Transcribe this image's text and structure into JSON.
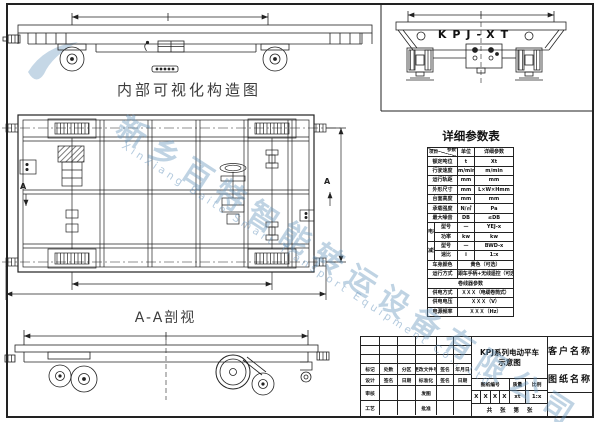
{
  "labels": {
    "internal_view": "内部可视化构造图",
    "section_view": "A-A剖视",
    "model": "KPJ-XT",
    "section_marker_left": "A",
    "section_marker_right": "A"
  },
  "watermark": {
    "company_cn": "新乡百特智能转运设备有限公司",
    "company_en": "Xinxiang Baite Smart Transport Equipment Co., Ltd"
  },
  "param_table": {
    "title": "详细参数表",
    "header": {
      "corner_top": "参数",
      "corner_bottom": "项目",
      "unit": "单位",
      "value": "详细参数"
    },
    "rows": [
      {
        "label": "额定吨位",
        "unit": "t",
        "value": "Xt"
      },
      {
        "label": "行驶速度",
        "unit": "m/min",
        "value": "m/min"
      },
      {
        "label": "运行轨距",
        "unit": "mm",
        "value": "mm"
      },
      {
        "label": "外形尺寸",
        "unit": "mm",
        "value": "L×W×Hmm"
      },
      {
        "label": "台面高度",
        "unit": "mm",
        "value": "mm"
      },
      {
        "label": "承载强度",
        "unit": "N/㎡",
        "value": "Pa"
      },
      {
        "label": "最大噪音",
        "unit": "DB",
        "value": "≤DB"
      },
      {
        "group": "电机",
        "label": "型号",
        "unit": "—",
        "value": "YEJ-x"
      },
      {
        "label": "功率",
        "unit": "kw",
        "value": "kw"
      },
      {
        "group": "减速机",
        "label": "型号",
        "unit": "—",
        "value": "BWD-x"
      },
      {
        "label": "速比",
        "unit": "i",
        "value": "1:x"
      },
      {
        "label": "车身颜色",
        "value": "黄色（可选）"
      },
      {
        "label": "运行方式",
        "value": "跟车手柄+无线遥控（可选）"
      },
      {
        "section": "卷线器参数"
      },
      {
        "label": "供电方式",
        "value": "ＸＸＸ（电缆卷筒式）"
      },
      {
        "label": "供电电压",
        "value": "ＸＸＸ（V）"
      },
      {
        "label": "电源频率",
        "value": "ＸＸＸ（Hz）"
      }
    ]
  },
  "title_block": {
    "rev_row": [
      "标记",
      "处数",
      "分区",
      "更改文件号",
      "签名",
      "年月日"
    ],
    "sign_row": [
      "设计",
      "签名",
      "日期",
      "标准化",
      "签名",
      "日期"
    ],
    "check_label": "审核",
    "issue_label": "发图",
    "process_label": "工艺",
    "approve_label": "批准",
    "title_line1": "KPJ系列电动平车",
    "title_line2": "示意图",
    "no_label": "图纸编号",
    "weight_label": "质量",
    "scale_label": "比例",
    "no_value": [
      "X",
      "X",
      "X",
      "X"
    ],
    "weight_value": "xt",
    "scale_value": "1:x",
    "sheet_text": "共 张 第 张",
    "customer_label": "客户名称",
    "drawing_label": "图纸名称"
  }
}
